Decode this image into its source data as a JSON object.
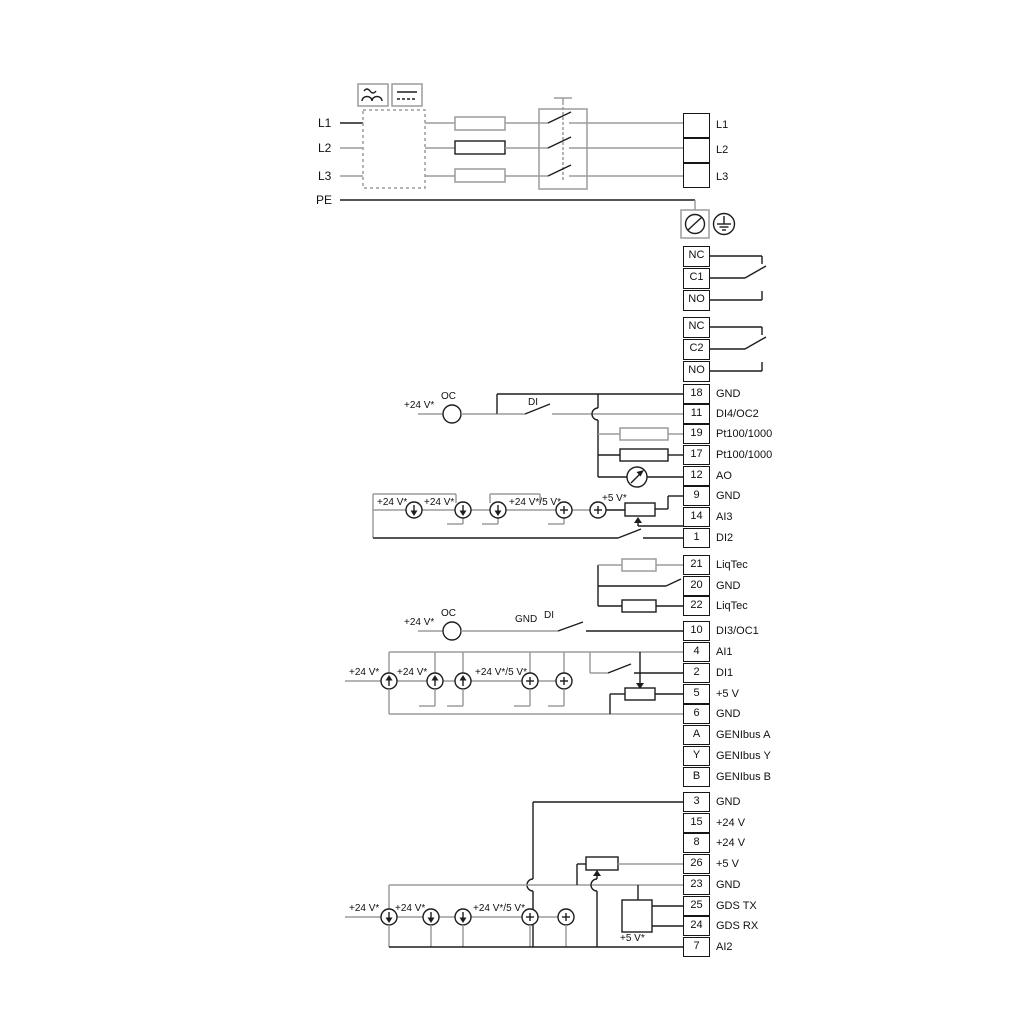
{
  "colors": {
    "line_black": "#1d1d1d",
    "line_gray": "#9c9c9c"
  },
  "mains": {
    "left": [
      "L1",
      "L2",
      "L3",
      "PE"
    ],
    "right": [
      "L1",
      "L2",
      "L3"
    ]
  },
  "relays": {
    "r1": [
      "NC",
      "C1",
      "NO"
    ],
    "r2": [
      "NC",
      "C2",
      "NO"
    ]
  },
  "terminals": {
    "io": [
      {
        "n": "18",
        "l": "GND"
      },
      {
        "n": "11",
        "l": "DI4/OC2"
      },
      {
        "n": "19",
        "l": "Pt100/1000"
      },
      {
        "n": "17",
        "l": "Pt100/1000"
      },
      {
        "n": "12",
        "l": "AO"
      },
      {
        "n": "9",
        "l": "GND"
      },
      {
        "n": "14",
        "l": "AI3"
      },
      {
        "n": "1",
        "l": "DI2"
      }
    ],
    "liqtec": [
      {
        "n": "21",
        "l": "LiqTec"
      },
      {
        "n": "20",
        "l": "GND"
      },
      {
        "n": "22",
        "l": "LiqTec"
      }
    ],
    "mid": [
      {
        "n": "10",
        "l": "DI3/OC1"
      },
      {
        "n": "4",
        "l": "AI1"
      },
      {
        "n": "2",
        "l": "DI1"
      },
      {
        "n": "5",
        "l": "+5 V"
      },
      {
        "n": "6",
        "l": "GND"
      },
      {
        "n": "A",
        "l": "GENIbus A"
      },
      {
        "n": "Y",
        "l": "GENIbus Y"
      },
      {
        "n": "B",
        "l": "GENIbus B"
      }
    ],
    "bottom": [
      {
        "n": "3",
        "l": "GND"
      },
      {
        "n": "15",
        "l": "+24 V"
      },
      {
        "n": "8",
        "l": "+24 V"
      },
      {
        "n": "26",
        "l": "+5 V"
      },
      {
        "n": "23",
        "l": "GND"
      },
      {
        "n": "25",
        "l": "GDS TX"
      },
      {
        "n": "24",
        "l": "GDS RX"
      },
      {
        "n": "7",
        "l": "AI2"
      }
    ]
  },
  "labels": {
    "v24": "+24 V*",
    "v24_5": "+24 V*/5 V*",
    "v5": "+5 V*",
    "oc": "OC",
    "di": "DI",
    "gnd": "GND"
  }
}
